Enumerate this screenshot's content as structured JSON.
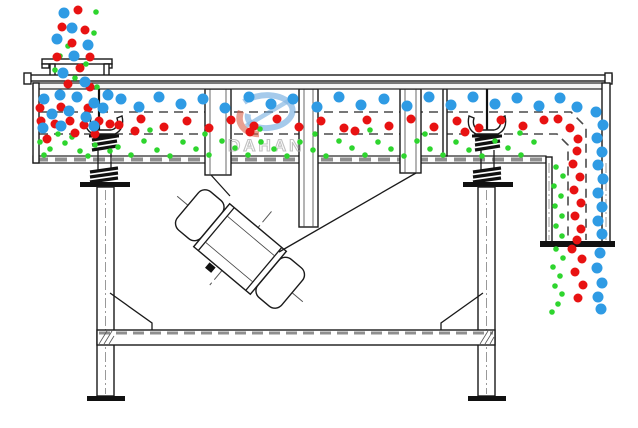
{
  "canvas": {
    "width": 638,
    "height": 428
  },
  "watermark": {
    "brand": "DAHAN",
    "registered": "®"
  },
  "colors": {
    "blue": "#2f9be4",
    "red": "#e81212",
    "green": "#2ed52e"
  },
  "particles": {
    "radius": {
      "blue": 5.5,
      "red": 4.5,
      "green": 2.8
    },
    "blue": [
      [
        64,
        13
      ],
      [
        57,
        39
      ],
      [
        72,
        28
      ],
      [
        88,
        45
      ],
      [
        74,
        56
      ],
      [
        63,
        73
      ],
      [
        85,
        82
      ],
      [
        44,
        99
      ],
      [
        60,
        95
      ],
      [
        77,
        97
      ],
      [
        94,
        103
      ],
      [
        52,
        114
      ],
      [
        69,
        111
      ],
      [
        86,
        117
      ],
      [
        103,
        108
      ],
      [
        43,
        128
      ],
      [
        61,
        126
      ],
      [
        108,
        95
      ],
      [
        94,
        126
      ],
      [
        121,
        99
      ],
      [
        139,
        107
      ],
      [
        159,
        97
      ],
      [
        181,
        104
      ],
      [
        203,
        99
      ],
      [
        225,
        108
      ],
      [
        249,
        97
      ],
      [
        271,
        104
      ],
      [
        293,
        99
      ],
      [
        317,
        107
      ],
      [
        339,
        97
      ],
      [
        361,
        105
      ],
      [
        384,
        99
      ],
      [
        407,
        106
      ],
      [
        429,
        97
      ],
      [
        451,
        105
      ],
      [
        473,
        97
      ],
      [
        495,
        104
      ],
      [
        517,
        98
      ],
      [
        539,
        106
      ],
      [
        560,
        98
      ],
      [
        577,
        107
      ],
      [
        596,
        112
      ],
      [
        603,
        125
      ],
      [
        597,
        138
      ],
      [
        602,
        152
      ],
      [
        598,
        165
      ],
      [
        603,
        179
      ],
      [
        598,
        193
      ],
      [
        602,
        207
      ],
      [
        598,
        221
      ],
      [
        602,
        234
      ],
      [
        600,
        253
      ],
      [
        597,
        268
      ],
      [
        602,
        283
      ],
      [
        598,
        297
      ],
      [
        601,
        309
      ]
    ],
    "red": [
      [
        78,
        10
      ],
      [
        62,
        27
      ],
      [
        85,
        30
      ],
      [
        72,
        43
      ],
      [
        90,
        57
      ],
      [
        80,
        68
      ],
      [
        68,
        84
      ],
      [
        90,
        87
      ],
      [
        57,
        57
      ],
      [
        41,
        121
      ],
      [
        55,
        124
      ],
      [
        70,
        121
      ],
      [
        84,
        125
      ],
      [
        99,
        121
      ],
      [
        47,
        139
      ],
      [
        40,
        108
      ],
      [
        95,
        134
      ],
      [
        110,
        124
      ],
      [
        61,
        107
      ],
      [
        75,
        133
      ],
      [
        88,
        108
      ],
      [
        119,
        125
      ],
      [
        141,
        119
      ],
      [
        164,
        127
      ],
      [
        187,
        121
      ],
      [
        209,
        128
      ],
      [
        231,
        120
      ],
      [
        254,
        126
      ],
      [
        277,
        119
      ],
      [
        299,
        127
      ],
      [
        321,
        121
      ],
      [
        344,
        128
      ],
      [
        367,
        120
      ],
      [
        389,
        126
      ],
      [
        411,
        119
      ],
      [
        434,
        127
      ],
      [
        457,
        121
      ],
      [
        479,
        128
      ],
      [
        501,
        120
      ],
      [
        523,
        126
      ],
      [
        544,
        120
      ],
      [
        135,
        131
      ],
      [
        250,
        132
      ],
      [
        355,
        131
      ],
      [
        465,
        132
      ],
      [
        558,
        119
      ],
      [
        570,
        128
      ],
      [
        578,
        139
      ],
      [
        577,
        151
      ],
      [
        573,
        164
      ],
      [
        580,
        177
      ],
      [
        574,
        190
      ],
      [
        581,
        203
      ],
      [
        575,
        216
      ],
      [
        581,
        229
      ],
      [
        577,
        240
      ],
      [
        572,
        249
      ],
      [
        582,
        259
      ],
      [
        575,
        272
      ],
      [
        583,
        285
      ],
      [
        578,
        298
      ]
    ],
    "green": [
      [
        96,
        12
      ],
      [
        68,
        46
      ],
      [
        94,
        33
      ],
      [
        60,
        56
      ],
      [
        86,
        64
      ],
      [
        75,
        78
      ],
      [
        97,
        87
      ],
      [
        55,
        70
      ],
      [
        50,
        149
      ],
      [
        65,
        143
      ],
      [
        80,
        151
      ],
      [
        95,
        145
      ],
      [
        110,
        151
      ],
      [
        44,
        155
      ],
      [
        58,
        134
      ],
      [
        72,
        137
      ],
      [
        88,
        156
      ],
      [
        40,
        142
      ],
      [
        150,
        130
      ],
      [
        205,
        134
      ],
      [
        260,
        129
      ],
      [
        315,
        134
      ],
      [
        370,
        130
      ],
      [
        425,
        134
      ],
      [
        480,
        129
      ],
      [
        520,
        133
      ],
      [
        118,
        147
      ],
      [
        131,
        155
      ],
      [
        144,
        141
      ],
      [
        157,
        150
      ],
      [
        170,
        156
      ],
      [
        183,
        142
      ],
      [
        196,
        149
      ],
      [
        209,
        155
      ],
      [
        222,
        141
      ],
      [
        235,
        148
      ],
      [
        248,
        155
      ],
      [
        261,
        142
      ],
      [
        274,
        149
      ],
      [
        287,
        156
      ],
      [
        300,
        142
      ],
      [
        313,
        150
      ],
      [
        326,
        156
      ],
      [
        339,
        141
      ],
      [
        352,
        148
      ],
      [
        365,
        155
      ],
      [
        378,
        142
      ],
      [
        391,
        149
      ],
      [
        404,
        156
      ],
      [
        417,
        141
      ],
      [
        430,
        149
      ],
      [
        443,
        155
      ],
      [
        456,
        142
      ],
      [
        469,
        150
      ],
      [
        482,
        156
      ],
      [
        495,
        141
      ],
      [
        508,
        148
      ],
      [
        521,
        155
      ],
      [
        534,
        142
      ],
      [
        556,
        167
      ],
      [
        563,
        176
      ],
      [
        554,
        186
      ],
      [
        561,
        196
      ],
      [
        555,
        206
      ],
      [
        562,
        216
      ],
      [
        556,
        226
      ],
      [
        562,
        236
      ],
      [
        556,
        249
      ],
      [
        563,
        258
      ],
      [
        553,
        267
      ],
      [
        560,
        276
      ],
      [
        555,
        286
      ],
      [
        562,
        294
      ],
      [
        558,
        304
      ],
      [
        552,
        312
      ]
    ]
  }
}
